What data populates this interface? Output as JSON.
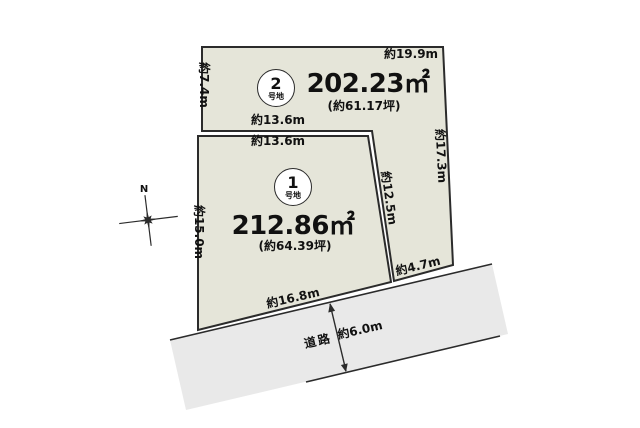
{
  "colors": {
    "background": "#ffffff",
    "parcel_fill": "#e5e5d9",
    "road_fill": "#e9e9e9",
    "line": "#2b2b2b",
    "text": "#111111",
    "circle_fill": "#ffffff"
  },
  "compass": {
    "north_label": "N"
  },
  "parcel2": {
    "number": "2",
    "number_suffix": "号地",
    "area": "202.23㎡",
    "area_tsubo": "(約61.17坪)",
    "dim_top": "約19.9m",
    "dim_left": "約7.4m",
    "dim_bottom": "約13.6m",
    "dim_right": "約17.3m",
    "dim_road_side": "約4.7m"
  },
  "parcel1": {
    "number": "1",
    "number_suffix": "号地",
    "area": "212.86㎡",
    "area_tsubo": "(約64.39坪)",
    "dim_top": "約13.6m",
    "dim_left": "約15.0m",
    "dim_right": "約12.5m",
    "dim_frontage": "約16.8m"
  },
  "road": {
    "label": "道路",
    "dim_width": "約6.0m"
  }
}
